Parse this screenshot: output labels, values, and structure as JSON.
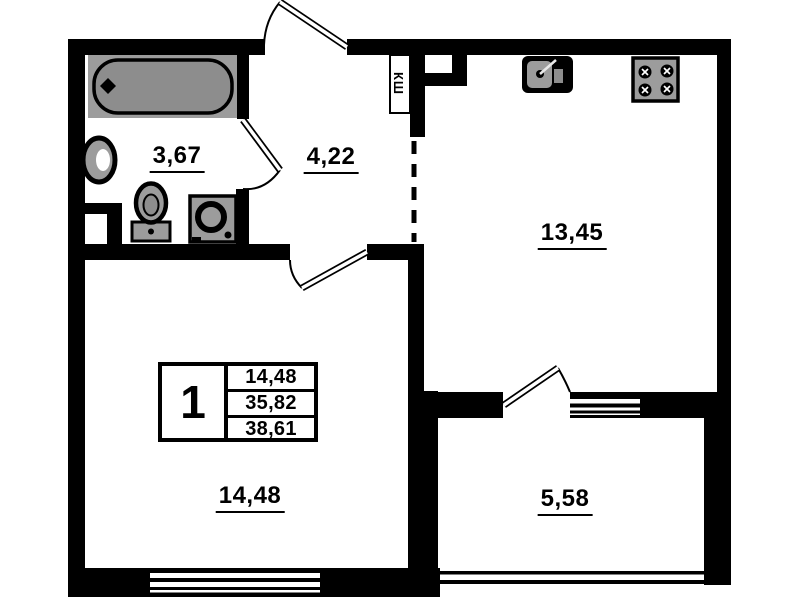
{
  "plan_type": "apartment-floor-plan",
  "rooms": {
    "bathroom": {
      "area_label": "3,67"
    },
    "hallway": {
      "area_label": "4,22"
    },
    "kitchen": {
      "area_label": "13,45"
    },
    "living_room": {
      "area_label": "14,48"
    },
    "balcony": {
      "area_label": "5,58"
    }
  },
  "closet": {
    "label": "КШ"
  },
  "info_box": {
    "rooms_count": "1",
    "living_area": "14,48",
    "apartment_area": "35,82",
    "total_area": "38,61"
  },
  "colors": {
    "wall": "#000000",
    "background": "#ffffff",
    "fixture_gray": "#9c9c9c",
    "tub_gray": "#8d8d8d"
  }
}
